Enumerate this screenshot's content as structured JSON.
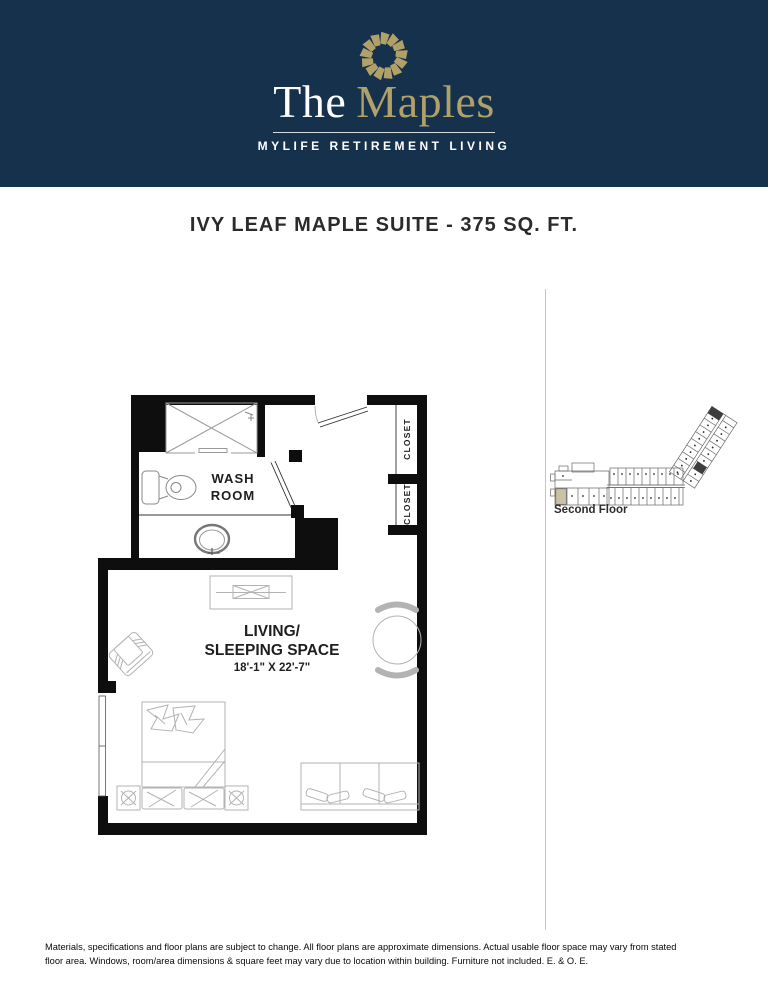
{
  "colors": {
    "navy": "#15314c",
    "gold": "#b1a068",
    "divider_line": "#ccc6ae",
    "wall_black": "#0e0e0e",
    "highlight_tan": "#cbc1a4"
  },
  "header": {
    "brand_the": "The",
    "brand_name": "Maples",
    "tagline": "MYLIFE RETIREMENT LIVING",
    "logo_icon": "sunburst-icon"
  },
  "title": "IVY LEAF MAPLE SUITE - 375 SQ. FT.",
  "floor_plan": {
    "washroom_label_line1": "WASH",
    "washroom_label_line2": "ROOM",
    "closet_label_top": "CLOSET",
    "closet_label_bottom": "CLOSET",
    "living_label_line1": "LIVING/",
    "living_label_line2": "SLEEPING SPACE",
    "living_dimensions": "18'-1\" X 22'-7\""
  },
  "key_plan": {
    "caption": "Second Floor"
  },
  "disclaimer": {
    "line1": "Materials, specifications and floor plans are subject to change. All floor plans are approximate dimensions. Actual usable floor space may vary from stated",
    "line2": "floor area. Windows, room/area dimensions & square feet may vary due to location within building. Furniture not included. E. & O. E."
  }
}
